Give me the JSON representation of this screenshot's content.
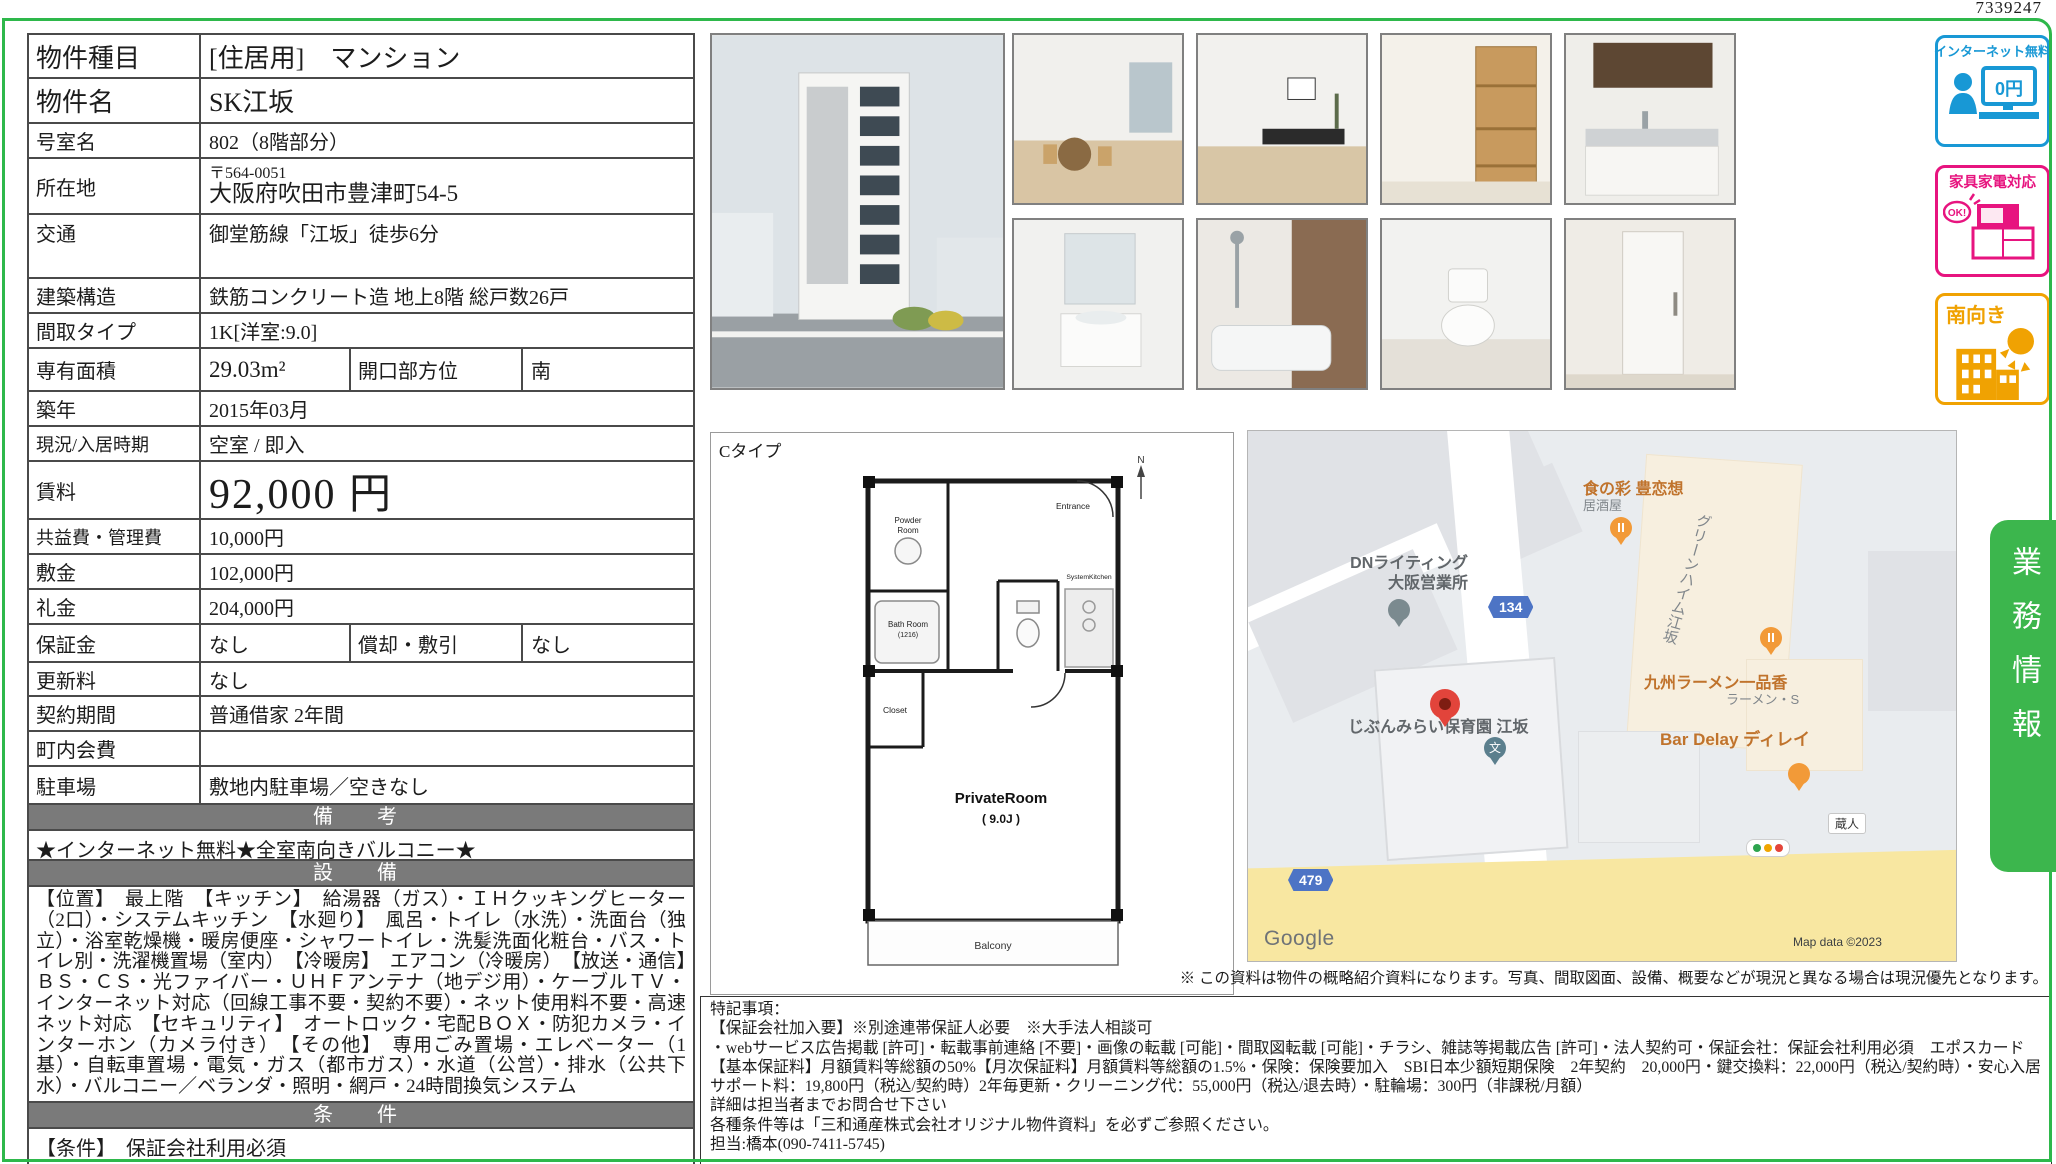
{
  "serial": "7339247",
  "colors": {
    "frame_green": "#2eb84b",
    "tab_green": "#3cb64d",
    "table_border_gray": "#4a4a4a",
    "section_header_gray": "#7a7a7a",
    "badge_blue": "#1898d5",
    "badge_pink": "#e7147f",
    "badge_orange": "#f0a202",
    "map_road_yellow": "#f8e7a1",
    "map_pin_red": "#e2443b"
  },
  "table": {
    "rows": [
      {
        "label": "物件種目",
        "value": "[住居用]　マンション"
      },
      {
        "label": "物件名",
        "value": "SK江坂"
      },
      {
        "label": "号室名",
        "value": "802（8階部分）"
      },
      {
        "label": "所在地",
        "zip": "〒564-0051",
        "value": "大阪府吹田市豊津町54-5"
      },
      {
        "label": "交通",
        "value": "御堂筋線「江坂」徒歩6分"
      },
      {
        "label": "建築構造",
        "value": "鉄筋コンクリート造 地上8階 総戸数26戸"
      },
      {
        "label": "間取タイプ",
        "value": "1K[洋室:9.0]"
      },
      {
        "label": "専有面積",
        "value": "29.03m²",
        "label2": "開口部方位",
        "value2": "南"
      },
      {
        "label": "築年",
        "value": "2015年03月"
      },
      {
        "label": "現況/入居時期",
        "value": "空室 / 即入"
      },
      {
        "label": "賃料",
        "value": "92,000 円"
      },
      {
        "label": "共益費・管理費",
        "value": "10,000円"
      },
      {
        "label": "敷金",
        "value": "102,000円"
      },
      {
        "label": "礼金",
        "value": "204,000円"
      },
      {
        "label": "保証金",
        "value": "なし",
        "label2": "償却・敷引",
        "value2": "なし"
      },
      {
        "label": "更新料",
        "value": "なし"
      },
      {
        "label": "契約期間",
        "value": "普通借家 2年間"
      },
      {
        "label": "町内会費",
        "value": ""
      },
      {
        "label": "駐車場",
        "value": "敷地内駐車場／空きなし"
      }
    ],
    "biko_header": "備　考",
    "biko_text": "★インターネット無料★全室南向きバルコニー★",
    "setsubi_header": "設　備",
    "setsubi_text": "【位置】　最上階　【キッチン】　給湯器（ガス）・ＩＨクッキングヒーター（2口）・システムキッチン　【水廻り】　風呂・トイレ（水洗）・洗面台（独立）・浴室乾燥機・暖房便座・シャワートイレ・洗髪洗面化粧台・バス・トイレ別・洗濯機置場（室内）　【冷暖房】　エアコン（冷暖房）　【放送・通信】　ＢＳ・ＣＳ・光ファイバー・ＵＨＦアンテナ（地デジ用）・ケーブルＴＶ・インターネット対応（回線工事不要・契約不要）・ネット使用料不要・高速ネット対応　【セキュリティ】　オートロック・宅配ＢＯＸ・防犯カメラ・インターホン（カメラ付き）　【その他】　専用ごみ置場・エレベーター（1基）・自転車置場・電気・ガス（都市ガス）・水道（公営）・排水（公共下水）・バルコニー／ベランダ・照明・網戸・24時間換気システム",
    "joken_header": "条　件",
    "joken_text": "【条件】　保証会社利用必須"
  },
  "photos": {
    "main": "building-exterior",
    "thumbs": [
      "living-room-1",
      "living-room-2",
      "closet",
      "kitchen",
      "washbasin",
      "bathroom",
      "toilet",
      "entrance-hall"
    ]
  },
  "badges": [
    {
      "label": "インターネット無料",
      "icon_text": "0円"
    },
    {
      "label": "家具家電対応",
      "icon_text": "OK!"
    },
    {
      "label": "南向き"
    }
  ],
  "gyomu": {
    "label": "業務情報"
  },
  "floorplan": {
    "type": "Cタイプ",
    "compass": "N",
    "entrance": "Entrance",
    "powder1": "Powder",
    "powder2": "Room",
    "bath1": "Bath Room",
    "bath2": "(1216)",
    "closet": "Closet",
    "kitchen": "SystemKitchen",
    "room": "PrivateRoom",
    "room_size": "( 9.0J )",
    "balcony": "Balcony"
  },
  "map": {
    "dn_line1": "DNライティング",
    "dn_line2": "大阪営業所",
    "route_134": "134",
    "route_479": "479",
    "izakaya_name": "食の彩 豊恋想",
    "izakaya_sub": "居酒屋",
    "green_heim": "グリーンハイム江坂",
    "ramen_name": "九州ラーメン一品香",
    "ramen_sub": "ラーメン・S",
    "school_name": "じぶんみらい保育園 江坂",
    "school_mark": "文",
    "bar_name": "Bar Delay ディレイ",
    "kurando": "蔵人",
    "google": "Google",
    "attribution": "Map data ©2023"
  },
  "disclaimer": "※ この資料は物件の概略紹介資料になります。写真、間取図面、設備、概要などが現況と異なる場合は現況優先となります。",
  "notes": {
    "lines": [
      "特記事項：",
      "【保証会社加入要】※別途連帯保証人必要　※大手法人相談可",
      "・webサービス広告掲載 [許可]・転載事前連絡 [不要]・画像の転載 [可能]・間取図転載 [可能]・チラシ、雑誌等掲載広告 [許可]・法人契約可・保証会社：保証会社利用必須　エポスカード　【基本保証料】月額賃料等総額の50%【月次保証料】月額賃料等総額の1.5%・保険：保険要加入　SBI日本少額短期保険　2年契約　20,000円・鍵交換料：22,000円（税込/契約時）・安心入居サポート料：19,800円（税込/契約時）2年毎更新・クリーニング代：55,000円（税込/退去時）・駐輪場：300円（非課税/月額）",
      "詳細は担当者までお問合せ下さい",
      "各種条件等は「三和通産株式会社オリジナル物件資料」を必ずご参照ください。",
      "担当:橋本(090-7411-5745)"
    ]
  }
}
